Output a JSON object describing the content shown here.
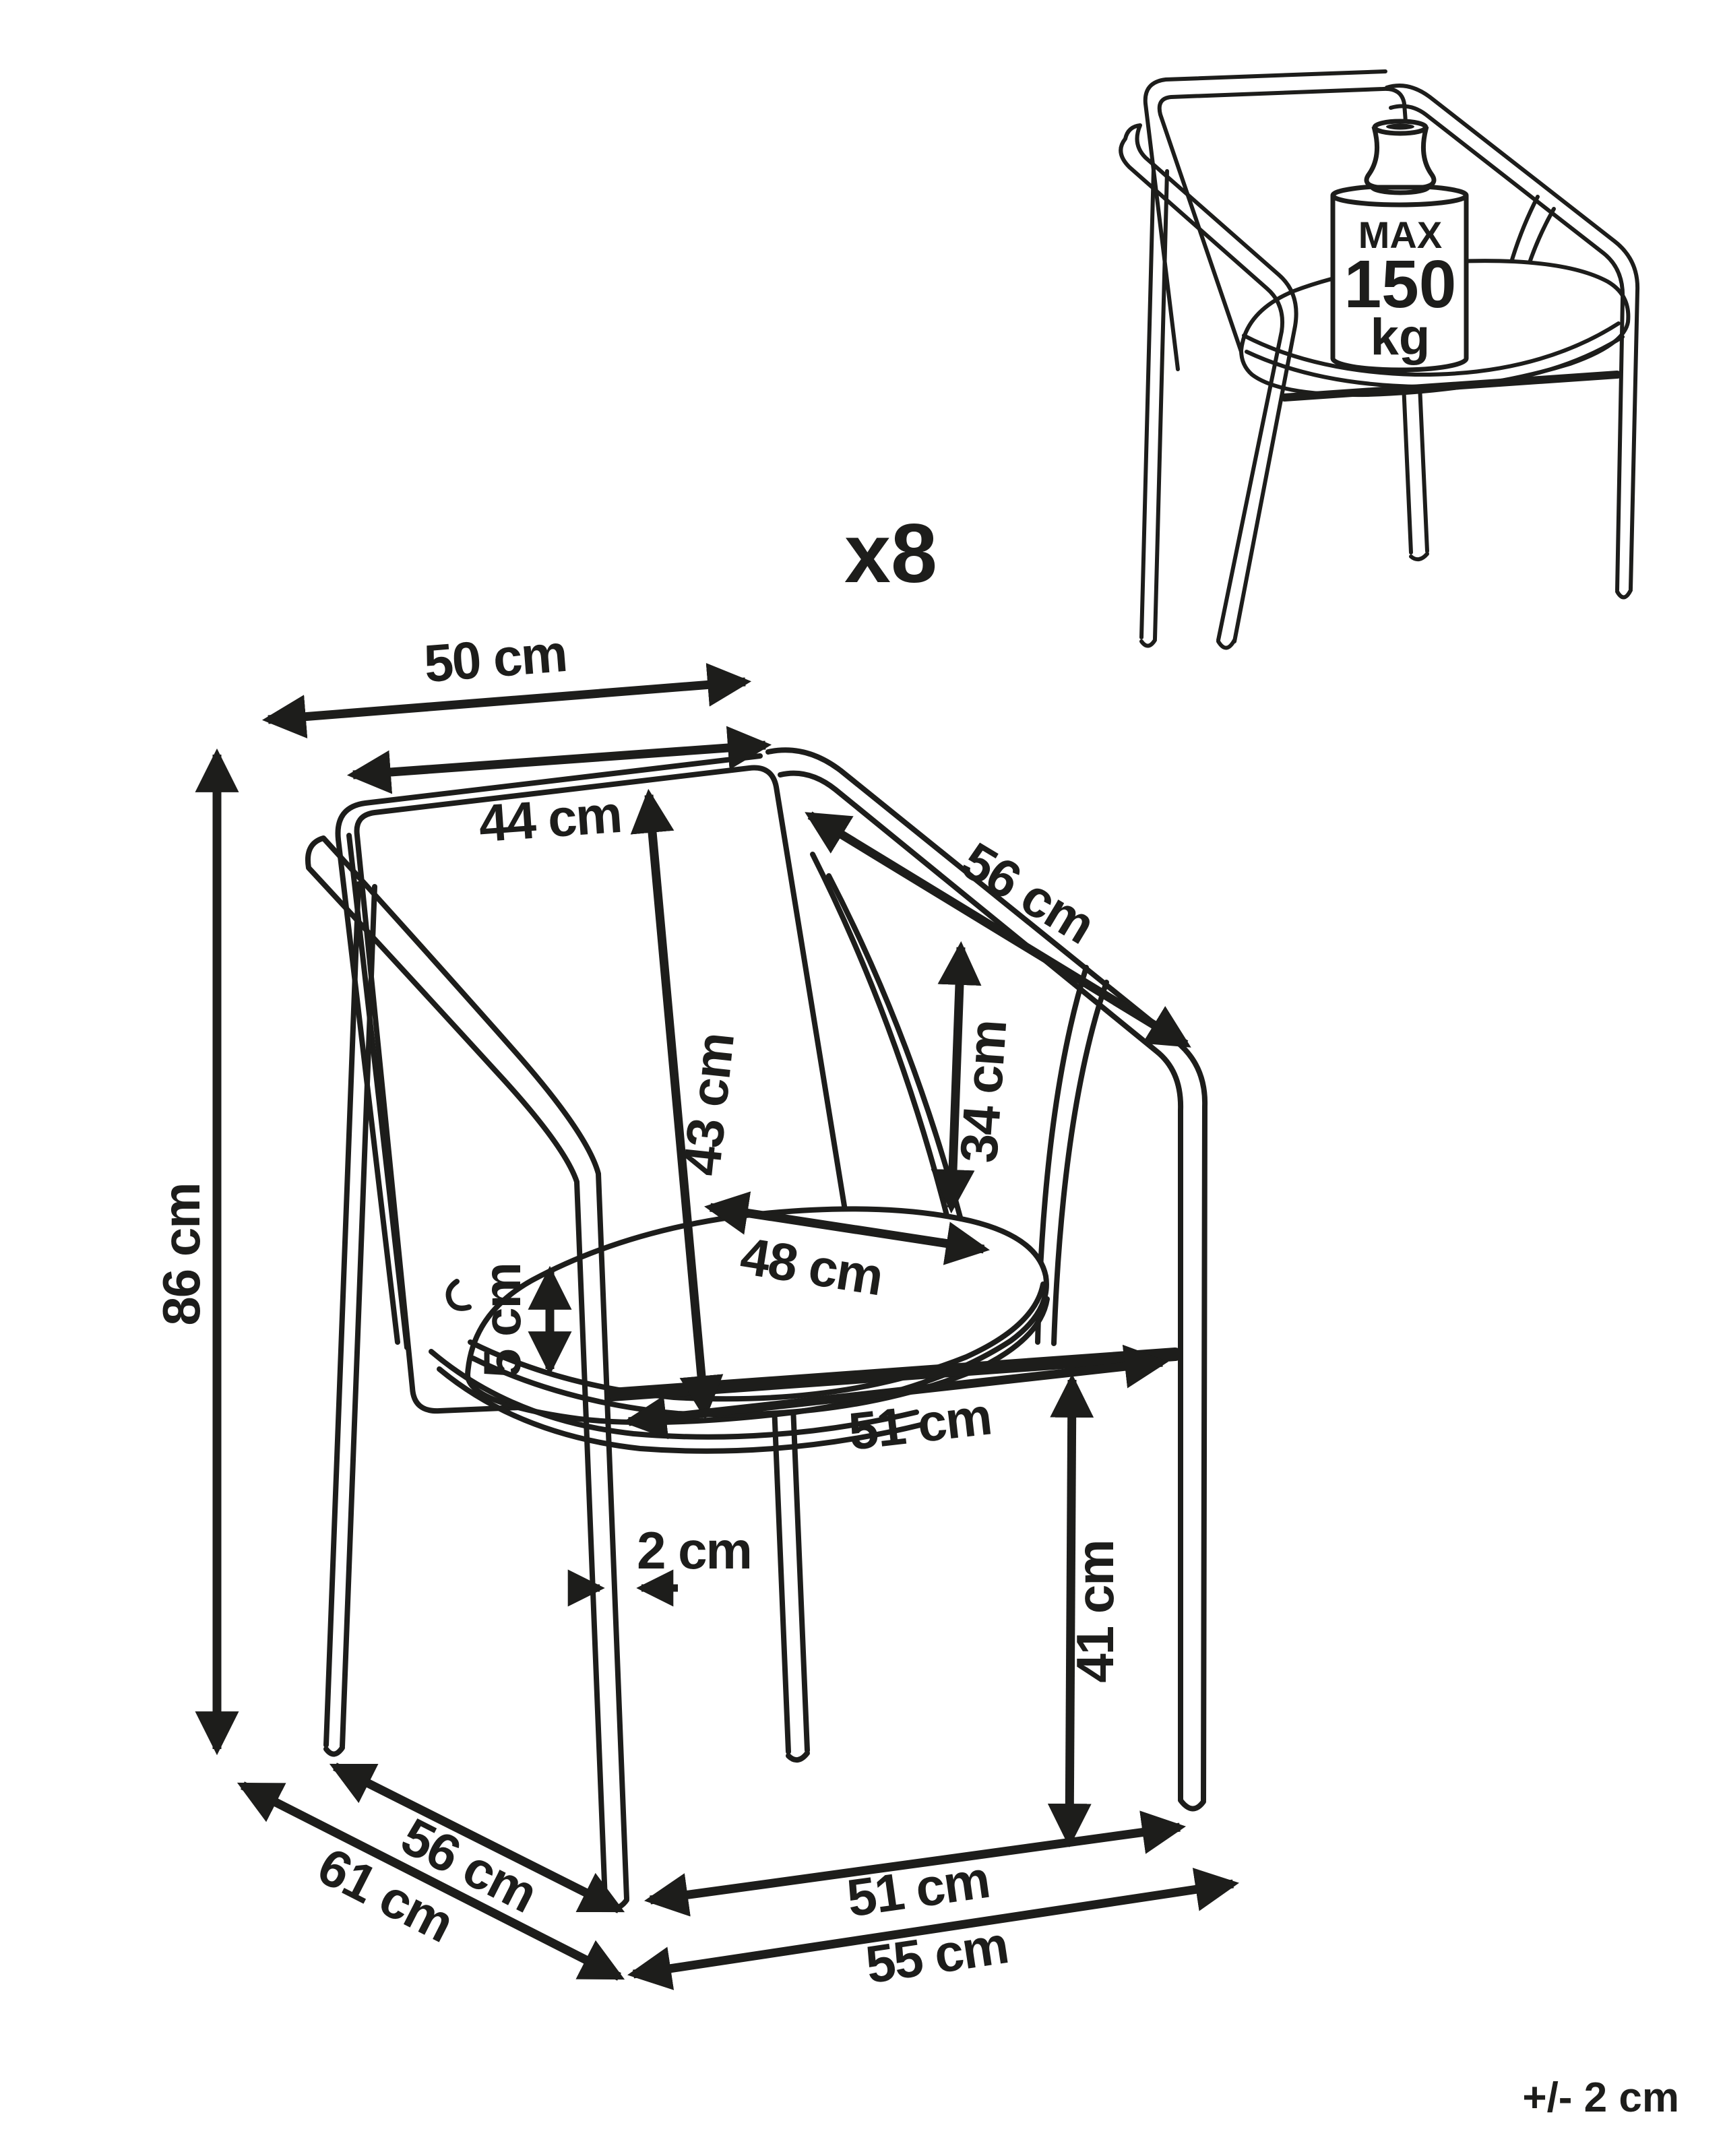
{
  "diagram": {
    "quantity_label": "x8",
    "quantity": 8,
    "tolerance_note": "+/- 2 cm",
    "tolerance_cm": 2,
    "max_load": {
      "line1": "MAX",
      "line2": "150",
      "line3": "kg"
    },
    "max_load_kg": 150,
    "labels": {
      "back_width": "50 cm",
      "backrest_width": "44 cm",
      "backrest_height": "43 cm",
      "armrest_length": "56 cm",
      "armrest_height": "34 cm",
      "seat_depth": "48 cm",
      "cushion_thickness": "5 cm",
      "seat_width_under": "51 cm",
      "leg_thickness": "2 cm",
      "seat_height": "41 cm",
      "total_height": "86 cm",
      "base_side_depth": "56 cm",
      "total_depth": "61 cm",
      "front_width": "51 cm",
      "base_width": "55 cm"
    },
    "values_cm": {
      "back_width": 50,
      "backrest_width": 44,
      "backrest_height": 43,
      "armrest_length": 56,
      "armrest_height": 34,
      "seat_depth": 48,
      "cushion_thickness": 5,
      "seat_width_under": 51,
      "leg_thickness": 2,
      "seat_height": 41,
      "total_height": 86,
      "base_side_depth": 56,
      "total_depth": 61,
      "front_width": 51,
      "base_width": 55
    },
    "ink_color": "#1d1d1b",
    "background_color": "#ffffff"
  }
}
